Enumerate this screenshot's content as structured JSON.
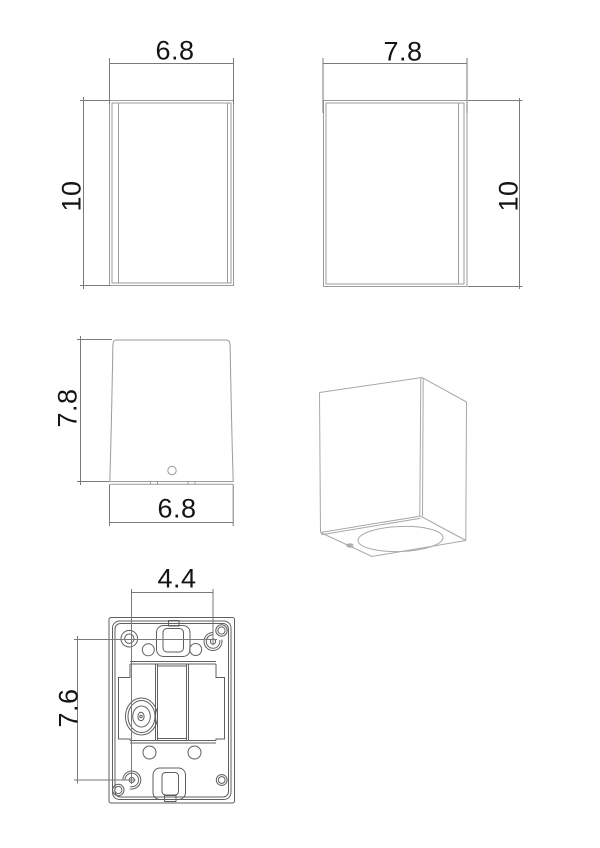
{
  "drawing": {
    "type": "technical-dimension-drawing",
    "units_shown": false,
    "colors": {
      "background": "#ffffff",
      "part_line_light": "#9b9b9b",
      "part_line_perspective": "#a8a8a8",
      "part_line_dark": "#5f5f5f",
      "dimension_line": "#7a7a7a",
      "text": "#141414"
    },
    "views": {
      "front": {
        "label": "front-view",
        "width_dim": "6.8",
        "height_dim": "10"
      },
      "side": {
        "label": "side-view",
        "width_dim": "7.8",
        "height_dim": "10"
      },
      "top": {
        "label": "top-view",
        "depth_dim": "7.8",
        "width_dim": "6.8"
      },
      "perspective": {
        "label": "perspective-view"
      },
      "back": {
        "label": "back-mounting-view",
        "hole_spacing_h": "4.4",
        "hole_spacing_v": "7.6"
      }
    }
  }
}
